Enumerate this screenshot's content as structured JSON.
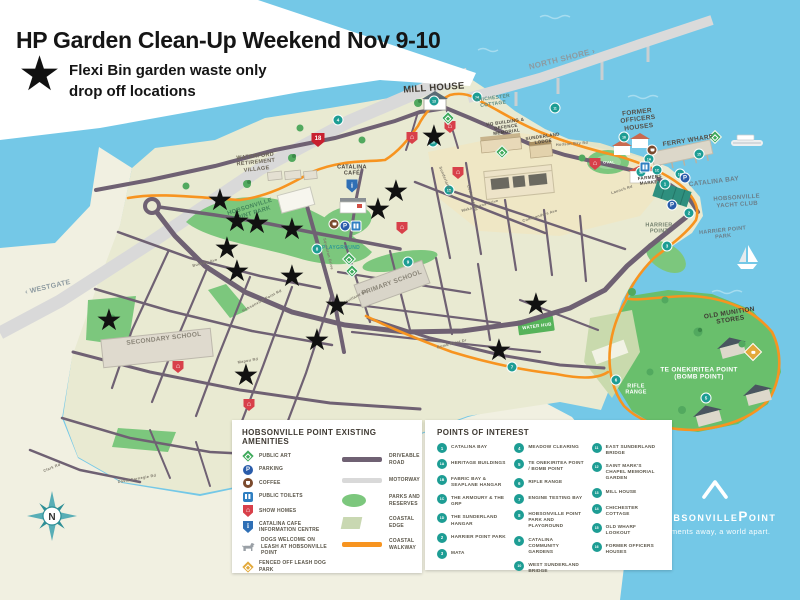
{
  "title": {
    "heading": "HP Garden Clean-Up Weekend Nov 9-10",
    "subtitle_line1": "Flexi Bin garden waste only",
    "subtitle_line2": "drop off locations"
  },
  "icons": {
    "star": "★",
    "house": "⌂",
    "info": "i",
    "parking": "P"
  },
  "colors": {
    "water": "#74C8E7",
    "land": "#F1F0E1",
    "peninsula": "#E9EAD2",
    "park_green": "#7CC77D",
    "bomb_point_green": "#69BF6C",
    "road": "#6F6173",
    "motorway": "#D9D9D9",
    "coastal_walkway": "#F79420",
    "poi_teal": "#1D9D94",
    "star_black": "#111111",
    "show_homes_red": "#D8404A",
    "parking_blue": "#2A5CAA",
    "toilets_blue": "#2F7FC1",
    "coffee_brown": "#7B4A2D",
    "dog_park_gold": "#E2A93B",
    "highway_red": "#C8202F"
  },
  "map": {
    "stars": [
      [
        434,
        139
      ],
      [
        396,
        194
      ],
      [
        378,
        212
      ],
      [
        220,
        203
      ],
      [
        237,
        224
      ],
      [
        257,
        226
      ],
      [
        292,
        232
      ],
      [
        227,
        251
      ],
      [
        237,
        274
      ],
      [
        292,
        279
      ],
      [
        337,
        308
      ],
      [
        109,
        323
      ],
      [
        317,
        343
      ],
      [
        246,
        378
      ],
      [
        536,
        307
      ],
      [
        499,
        353
      ]
    ],
    "labels": [
      {
        "text": "WATERFORD RETIREMENT VILLAGE",
        "x": 256,
        "y": 163,
        "size": 5.5,
        "rot": -6,
        "color": "#6B6456",
        "w": 58
      },
      {
        "text": "MILL HOUSE",
        "x": 434,
        "y": 89,
        "size": 9.5,
        "rot": -4,
        "color": "#3F3A33"
      },
      {
        "text": "CHICHESTER COTTAGE",
        "x": 493,
        "y": 102,
        "size": 5,
        "rot": -8,
        "color": "#5A8A80",
        "w": 40
      },
      {
        "text": "NORTH SHORE ›",
        "x": 562,
        "y": 59,
        "size": 8,
        "rot": -14,
        "color": "#8D9AA0"
      },
      {
        "text": "‹ WESTGATE",
        "x": 48,
        "y": 288,
        "size": 7,
        "rot": -13,
        "color": "#8D9AA0"
      },
      {
        "text": "FORMER OFFICERS HOUSES",
        "x": 638,
        "y": 120,
        "size": 6.5,
        "rot": -7,
        "color": "#54504A",
        "w": 58
      },
      {
        "text": "FERRY WHARF",
        "x": 688,
        "y": 141,
        "size": 6.5,
        "rot": -9,
        "color": "#54504A"
      },
      {
        "text": "CATALINA BAY",
        "x": 714,
        "y": 182,
        "size": 6.5,
        "rot": -7,
        "color": "#6A7F8A"
      },
      {
        "text": "HOBSONVILLE YACHT CLUB",
        "x": 737,
        "y": 202,
        "size": 6,
        "rot": -4,
        "color": "#6A7F8A",
        "w": 60
      },
      {
        "text": "HARRIER POINT",
        "x": 659,
        "y": 229,
        "size": 5.5,
        "rot": 0,
        "color": "#73806E",
        "w": 40
      },
      {
        "text": "HARRIER POINT PARK",
        "x": 723,
        "y": 234,
        "size": 5.5,
        "rot": -6,
        "color": "#6A7F8A",
        "w": 50
      },
      {
        "text": "OLD MUNITION STORES",
        "x": 730,
        "y": 317,
        "size": 6.5,
        "rot": -9,
        "color": "#3F3A33",
        "w": 60
      },
      {
        "text": "TE ONEKIRITEA POINT (BOMB POINT)",
        "x": 699,
        "y": 374,
        "size": 6.5,
        "rot": 0,
        "color": "#FFFFFF",
        "w": 92
      },
      {
        "text": "RIFLE RANGE",
        "x": 636,
        "y": 390,
        "size": 5.5,
        "rot": 0,
        "color": "#FFFFFF",
        "w": 30
      },
      {
        "text": "HQ BUILDING & DEFENCE MEMORIAL",
        "x": 506,
        "y": 127,
        "size": 4.5,
        "rot": -8,
        "color": "#4A453E",
        "w": 44
      },
      {
        "text": "SUNDERLAND LODGE",
        "x": 543,
        "y": 139,
        "size": 4.5,
        "rot": -8,
        "color": "#4A453E",
        "w": 38
      },
      {
        "text": "FARMERS MARKET",
        "x": 650,
        "y": 180,
        "size": 4.5,
        "rot": -6,
        "color": "#4A453E",
        "w": 32
      },
      {
        "text": "CATALINA CAFÉ",
        "x": 352,
        "y": 171,
        "size": 5.5,
        "rot": 0,
        "color": "#4A453E",
        "w": 34
      },
      {
        "text": "HOBSONVILLE POINT PARK",
        "x": 251,
        "y": 211,
        "size": 6,
        "rot": -17,
        "color": "#44865A",
        "w": 64
      },
      {
        "text": "PLAYGROUND",
        "x": 341,
        "y": 249,
        "size": 5,
        "rot": 0,
        "color": "#2F9A94"
      },
      {
        "text": "PRIMARY SCHOOL",
        "x": 392,
        "y": 283,
        "size": 6.5,
        "rot": -20,
        "color": "#8A8578"
      },
      {
        "text": "SECONDARY SCHOOL",
        "x": 164,
        "y": 339,
        "size": 6.5,
        "rot": -7,
        "color": "#8A8578"
      },
      {
        "text": "WATER HUB",
        "x": 537,
        "y": 326,
        "size": 4.5,
        "rot": -8,
        "color": "#FFFFFF"
      },
      {
        "text": "OVAL",
        "x": 609,
        "y": 163,
        "size": 4,
        "rot": 0,
        "color": "#FFFFFF"
      },
      {
        "text": "Launch Rd",
        "x": 622,
        "y": 190,
        "size": 3.8,
        "rot": -18,
        "color": "#7D786B"
      },
      {
        "text": "Hudson Bay Rd",
        "x": 572,
        "y": 144,
        "size": 3.8,
        "rot": -4,
        "color": "#7D786B"
      },
      {
        "text": "Commanders Ave",
        "x": 540,
        "y": 216,
        "size": 3.8,
        "rot": -17,
        "color": "#7D786B"
      },
      {
        "text": "Waka Moana Drive",
        "x": 480,
        "y": 206,
        "size": 3.8,
        "rot": -16,
        "color": "#7D786B"
      },
      {
        "text": "De Havilland Rd",
        "x": 352,
        "y": 299,
        "size": 3.8,
        "rot": -27,
        "color": "#7D786B"
      },
      {
        "text": "Squadron Drive",
        "x": 328,
        "y": 254,
        "size": 3.8,
        "rot": 76,
        "color": "#7D786B"
      },
      {
        "text": "Sunderland Ave",
        "x": 446,
        "y": 182,
        "size": 3.8,
        "rot": 68,
        "color": "#7D786B"
      },
      {
        "text": "Cochrane Rd",
        "x": 472,
        "y": 198,
        "size": 3.8,
        "rot": 72,
        "color": "#7D786B"
      },
      {
        "text": "Hobsonville Point Rd",
        "x": 262,
        "y": 301,
        "size": 3.8,
        "rot": -28,
        "color": "#7D786B"
      },
      {
        "text": "Buckley Ave",
        "x": 205,
        "y": 263,
        "size": 3.8,
        "rot": -14,
        "color": "#7D786B"
      },
      {
        "text": "Clark Rd",
        "x": 52,
        "y": 468,
        "size": 3.8,
        "rot": -22,
        "color": "#7D786B"
      },
      {
        "text": "David Carnegie Rd",
        "x": 137,
        "y": 479,
        "size": 3.8,
        "rot": -10,
        "color": "#7D786B"
      },
      {
        "text": "Bomb Point Dr",
        "x": 452,
        "y": 344,
        "size": 3.8,
        "rot": -14,
        "color": "#7D786B"
      },
      {
        "text": "Mapou Rd",
        "x": 248,
        "y": 361,
        "size": 3.8,
        "rot": -10,
        "color": "#7D786B"
      }
    ],
    "markers": [
      {
        "type": "highway",
        "n": "18",
        "x": 318,
        "y": 140
      },
      {
        "type": "poi",
        "n": "13",
        "x": 434,
        "y": 101
      },
      {
        "type": "poi",
        "n": "14",
        "x": 477,
        "y": 97
      },
      {
        "type": "poi",
        "n": "16",
        "x": 624,
        "y": 137
      },
      {
        "type": "poi",
        "n": "15",
        "x": 699,
        "y": 154
      },
      {
        "type": "poi",
        "n": "12",
        "x": 641,
        "y": 172
      },
      {
        "type": "poi",
        "n": "1A",
        "x": 649,
        "y": 159
      },
      {
        "type": "poi",
        "n": "1C",
        "x": 657,
        "y": 170
      },
      {
        "type": "poi",
        "n": "1",
        "x": 665,
        "y": 184
      },
      {
        "type": "poi",
        "n": "1B",
        "x": 680,
        "y": 174
      },
      {
        "type": "poi",
        "n": "2",
        "x": 689,
        "y": 213
      },
      {
        "type": "poi",
        "n": "3",
        "x": 667,
        "y": 246
      },
      {
        "type": "poi",
        "n": "5",
        "x": 706,
        "y": 398
      },
      {
        "type": "poi",
        "n": "6",
        "x": 616,
        "y": 380
      },
      {
        "type": "poi",
        "n": "7",
        "x": 512,
        "y": 367
      },
      {
        "type": "poi",
        "n": "8",
        "x": 317,
        "y": 249
      },
      {
        "type": "poi",
        "n": "9",
        "x": 408,
        "y": 262
      },
      {
        "type": "poi",
        "n": "10",
        "x": 433,
        "y": 142
      },
      {
        "type": "poi",
        "n": "11",
        "x": 555,
        "y": 108
      },
      {
        "type": "poi",
        "n": "4",
        "x": 338,
        "y": 120
      },
      {
        "type": "poi",
        "n": "1D",
        "x": 449,
        "y": 190
      },
      {
        "type": "parking",
        "x": 345,
        "y": 226
      },
      {
        "type": "parking",
        "x": 685,
        "y": 178
      },
      {
        "type": "parking",
        "x": 672,
        "y": 205
      },
      {
        "type": "toilets",
        "x": 356,
        "y": 226
      },
      {
        "type": "toilets",
        "x": 645,
        "y": 167
      },
      {
        "type": "coffee",
        "x": 334,
        "y": 224
      },
      {
        "type": "coffee",
        "x": 652,
        "y": 150
      },
      {
        "type": "info",
        "x": 352,
        "y": 186
      },
      {
        "type": "show",
        "x": 412,
        "y": 138
      },
      {
        "type": "show",
        "x": 450,
        "y": 127
      },
      {
        "type": "show",
        "x": 458,
        "y": 173
      },
      {
        "type": "show",
        "x": 595,
        "y": 164
      },
      {
        "type": "show",
        "x": 402,
        "y": 228
      },
      {
        "type": "show",
        "x": 178,
        "y": 367
      },
      {
        "type": "show",
        "x": 249,
        "y": 405
      },
      {
        "type": "art",
        "x": 349,
        "y": 259
      },
      {
        "type": "art",
        "x": 352,
        "y": 271
      },
      {
        "type": "art",
        "x": 502,
        "y": 152
      },
      {
        "type": "art",
        "x": 715,
        "y": 137
      },
      {
        "type": "art",
        "x": 448,
        "y": 118
      },
      {
        "type": "dogpark",
        "x": 753,
        "y": 352
      }
    ]
  },
  "legend_amenities": {
    "title": "HOBSONVILLE POINT EXISTING AMENITIES",
    "items": [
      {
        "icon": "public-art",
        "label": "PUBLIC ART"
      },
      {
        "icon": "parking",
        "label": "PARKING"
      },
      {
        "icon": "coffee",
        "label": "COFFEE"
      },
      {
        "icon": "public-toilets",
        "label": "PUBLIC TOILETS"
      },
      {
        "icon": "show-homes",
        "label": "SHOW HOMES"
      },
      {
        "icon": "information-centre",
        "label": "CATALINA CAFE INFORMATION CENTRE"
      },
      {
        "icon": "dogs-welcome",
        "label": "DOGS WELCOME ON LEASH AT HOBSONVILLE POINT"
      },
      {
        "icon": "dog-park",
        "label": "FENCED OFF LEASH DOG PARK"
      }
    ],
    "line_items": [
      {
        "swatch": "driveable-road",
        "label": "DRIVEABLE ROAD"
      },
      {
        "swatch": "motorway",
        "label": "MOTORWAY"
      },
      {
        "swatch": "parks-and-reserves",
        "label": "PARKS AND RESERVES"
      },
      {
        "swatch": "coastal-edge",
        "label": "COASTAL EDGE"
      },
      {
        "swatch": "coastal-walkway",
        "label": "COASTAL WALKWAY"
      }
    ]
  },
  "poi": {
    "title": "POINTS OF INTEREST",
    "columns": [
      [
        {
          "num": "1",
          "label": "CATALINA BAY"
        },
        {
          "num": "1A",
          "label": "HERITAGE BUILDINGS"
        },
        {
          "num": "1B",
          "label": "FABRIC BAY & SEAPLANE HANGAR"
        },
        {
          "num": "1C",
          "label": "THE ARMOURY & THE GRP"
        },
        {
          "num": "1D",
          "label": "THE SUNDERLAND HANGAR"
        },
        {
          "num": "2",
          "label": "HARRIER POINT PARK"
        },
        {
          "num": "3",
          "label": "MATA"
        }
      ],
      [
        {
          "num": "4",
          "label": "MEADOW CLEARING"
        },
        {
          "num": "5",
          "label": "TE ONEKIRITEA POINT / BOMB POINT"
        },
        {
          "num": "6",
          "label": "RIFLE RANGE"
        },
        {
          "num": "7",
          "label": "ENGINE TESTING BAY"
        },
        {
          "num": "8",
          "label": "HOBSONVILLE POINT PARK AND PLAYGROUND"
        },
        {
          "num": "9",
          "label": "CATALINA COMMUNITY GARDENS"
        },
        {
          "num": "10",
          "label": "WEST SUNDERLAND BRIDGE"
        }
      ],
      [
        {
          "num": "11",
          "label": "EAST SUNDERLAND BRIDGE"
        },
        {
          "num": "12",
          "label": "SAINT MARK'S CHAPEL MEMORIAL GARDEN"
        },
        {
          "num": "13",
          "label": "MILL HOUSE"
        },
        {
          "num": "14",
          "label": "CHICHESTER COTTAGE"
        },
        {
          "num": "15",
          "label": "OLD WHARF LOOKOUT"
        },
        {
          "num": "16",
          "label": "FORMER OFFICERS HOUSES"
        }
      ]
    ]
  },
  "compass": {
    "letter": "N"
  },
  "logo": {
    "name": "HobsonvillePoint",
    "tagline": "Moments away, a world apart."
  }
}
